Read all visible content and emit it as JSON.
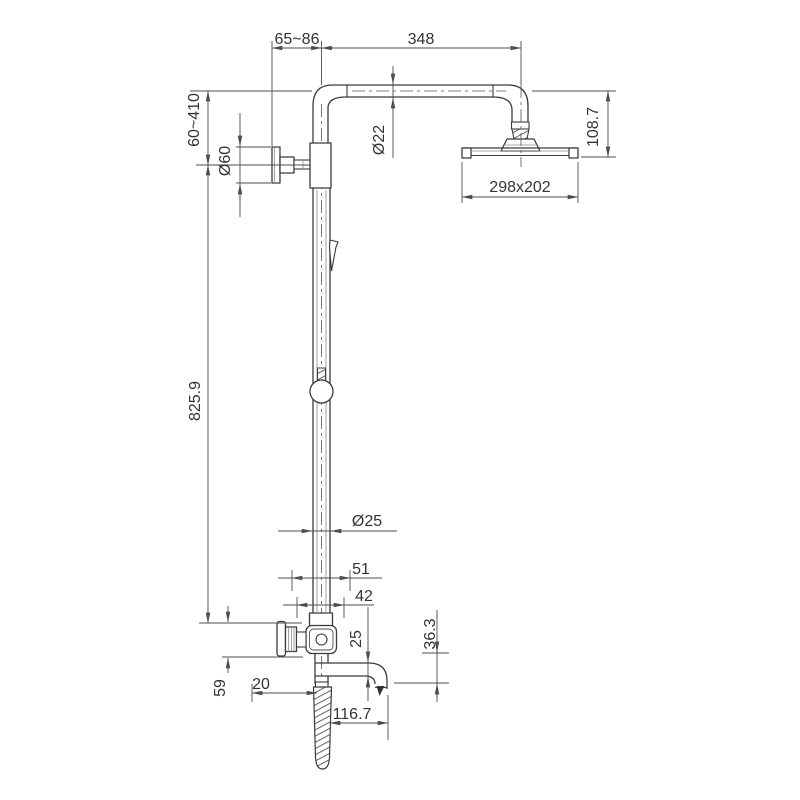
{
  "drawing": {
    "background": "#ffffff",
    "outline_color": "#3b3b3b",
    "dimension_color": "#4d4d4d",
    "labels": {
      "top_offset": "65~86",
      "arm_length": "348",
      "bracket_height_range": "60~410",
      "flange_diameter": "Ø60",
      "arm_pipe_diameter": "Ø22",
      "head_drop": "108.7",
      "head_size": "298x202",
      "riser_length": "825.9",
      "riser_diameter": "Ø25",
      "escutcheon_width": "51",
      "valve_width": "42",
      "spout_diameter": "25",
      "spout_drop": "36.3",
      "valve_height": "59",
      "hose_offset": "20",
      "spout_reach": "116.7"
    }
  }
}
